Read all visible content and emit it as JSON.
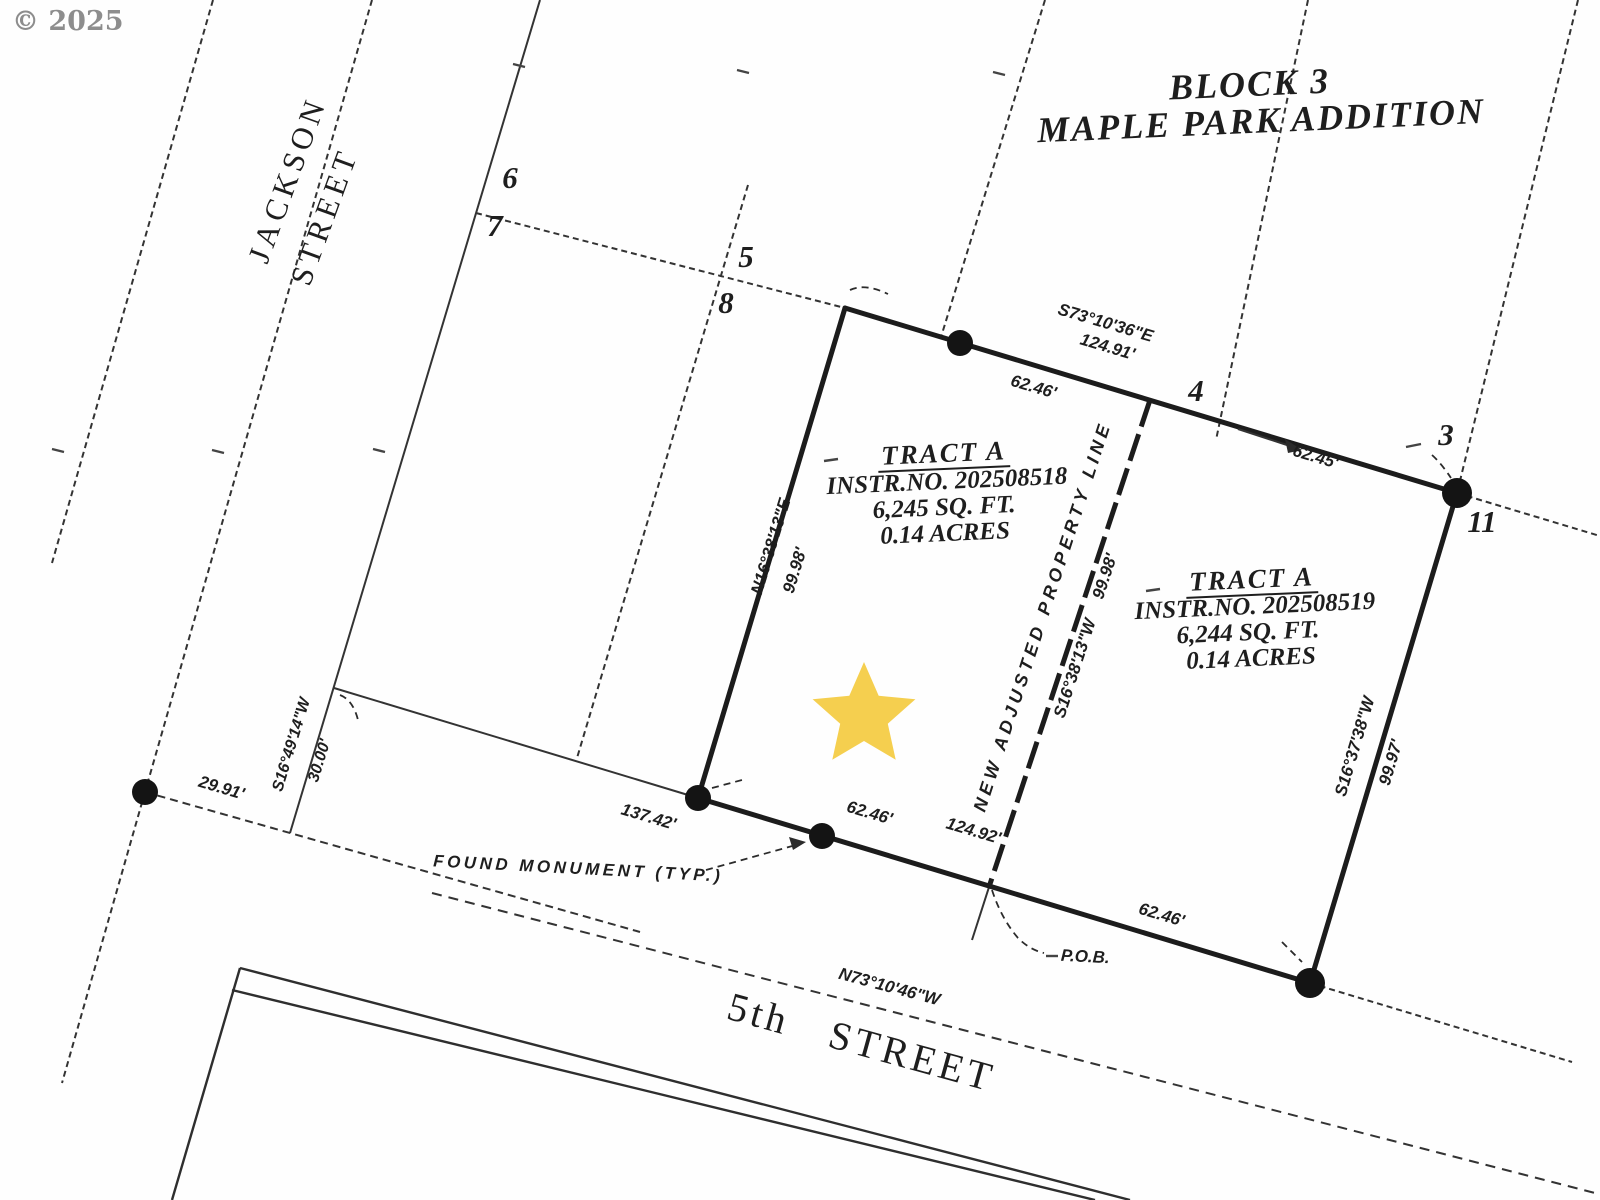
{
  "meta": {
    "watermark": "© 2025"
  },
  "title": {
    "line1": "BLOCK 3",
    "line2": "MAPLE PARK ADDITION"
  },
  "streets": {
    "jackson_line1": "JACKSON",
    "jackson_line2": "STREET",
    "fifth": "5th STREET",
    "fifth_bearing": "N73°10'46\"W"
  },
  "lots": [
    "6",
    "7",
    "5",
    "8",
    "4",
    "3",
    "11"
  ],
  "tracts": {
    "left": {
      "title": "TRACT A",
      "instr": "INSTR.NO. 202508518",
      "sqft": "6,245 SQ. FT.",
      "acres": "0.14 ACRES"
    },
    "right": {
      "title": "TRACT A",
      "instr": "INSTR.NO. 202508519",
      "sqft": "6,244 SQ. FT.",
      "acres": "0.14 ACRES"
    }
  },
  "dimensions": {
    "north_bearing": "S73°10'36\"E",
    "north_total": "124.91'",
    "north_left": "62.46'",
    "north_right": "62.45'",
    "west_bearing": "N16°38'13\"E",
    "west_dist": "99.98'",
    "middle_label": "NEW ADJUSTED PROPERTY LINE",
    "middle_bearing": "S16°38'13\"W",
    "middle_dist": "99.98'",
    "east_bearing": "S16°37'38\"W",
    "east_dist": "99.97'",
    "south_left": "137.42'",
    "south_seg": "62.46'",
    "south_total": "124.92'",
    "south_right": "62.46'",
    "row_dist": "29.91'",
    "side_bearing": "S16°49'14\"W",
    "side_dist": "30.00'"
  },
  "annotations": {
    "found_monument": "FOUND MONUMENT (TYP.)",
    "pob": "P.O.B."
  },
  "colors": {
    "ink": "#222222",
    "star": "#F5CF4F",
    "watermark": "#8d8d8d"
  }
}
